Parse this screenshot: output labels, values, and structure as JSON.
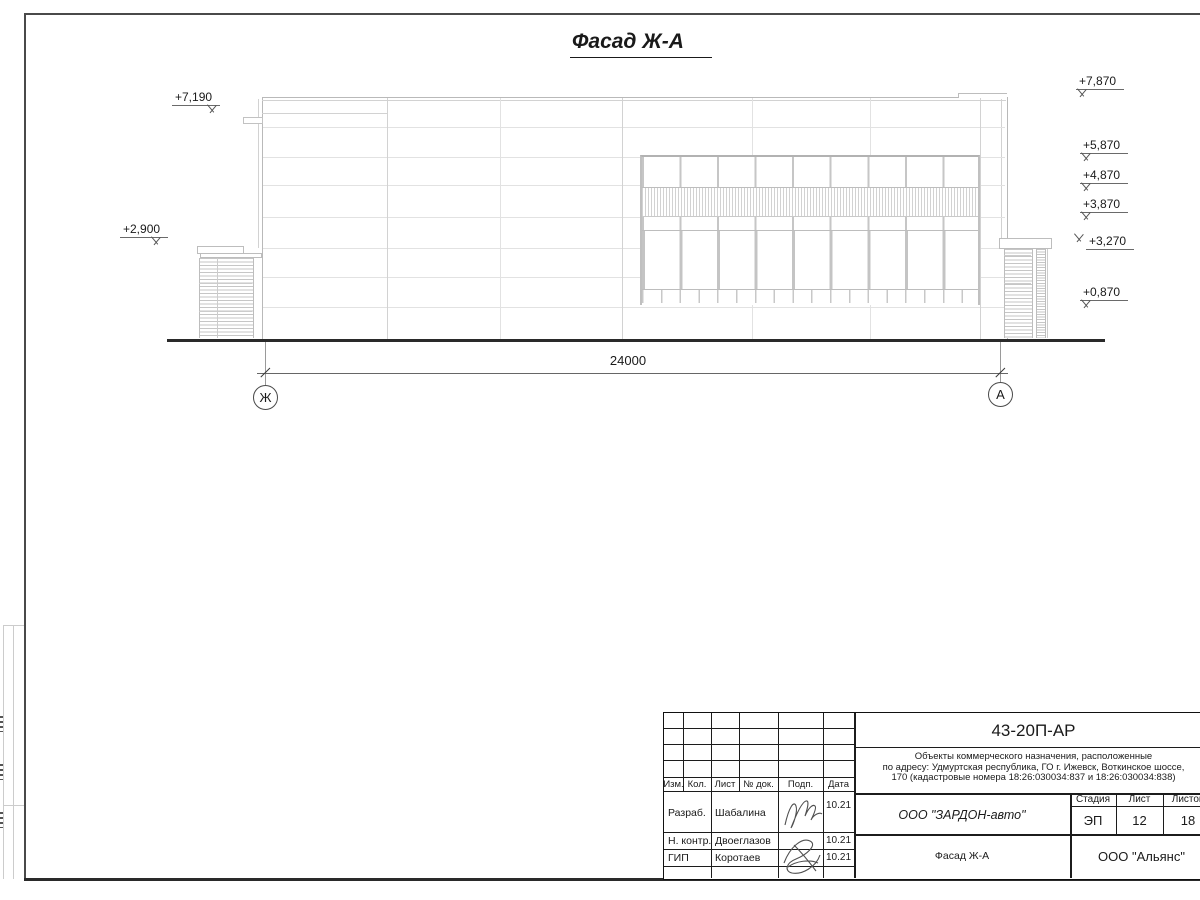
{
  "title": "Фасад Ж-А",
  "facade": {
    "dimension_label": "24000",
    "axis_left": "Ж",
    "axis_right": "А",
    "elev_left": [
      "+7,190",
      "+2,900"
    ],
    "elev_right": [
      "+7,870",
      "+5,870",
      "+4,870",
      "+3,870",
      "+3,270",
      "+0,870"
    ]
  },
  "title_block": {
    "doc_number": "43-20П-АР",
    "description_line1": "Объекты коммерческого назначения, расположенные",
    "description_line2": "по адресу: Удмуртская республика, ГО г. Ижевск, Воткинское шоссе,",
    "description_line3": "170 (кадастровые номера 18:26:030034:837 и 18:26:030034:838)",
    "header_cols": [
      "Изм.",
      "Кол.",
      "Лист",
      "№ док.",
      "Подп.",
      "Дата"
    ],
    "sign_rows": [
      {
        "role": "Разраб.",
        "name": "Шабалина",
        "date": "10.21"
      },
      {
        "role": "Н. контр.",
        "name": "Двоеглазов",
        "date": "10.21"
      },
      {
        "role": "ГИП",
        "name": "Коротаев",
        "date": "10.21"
      }
    ],
    "designer_company": "ООО \"ЗАРДОН-авто\"",
    "stage_label": "Стадия",
    "sheet_label": "Лист",
    "sheets_label": "Листов",
    "stage": "ЭП",
    "sheet": "12",
    "sheets": "18",
    "sheet_title": "Фасад Ж-А",
    "org": "ООО \"Альянс\""
  }
}
